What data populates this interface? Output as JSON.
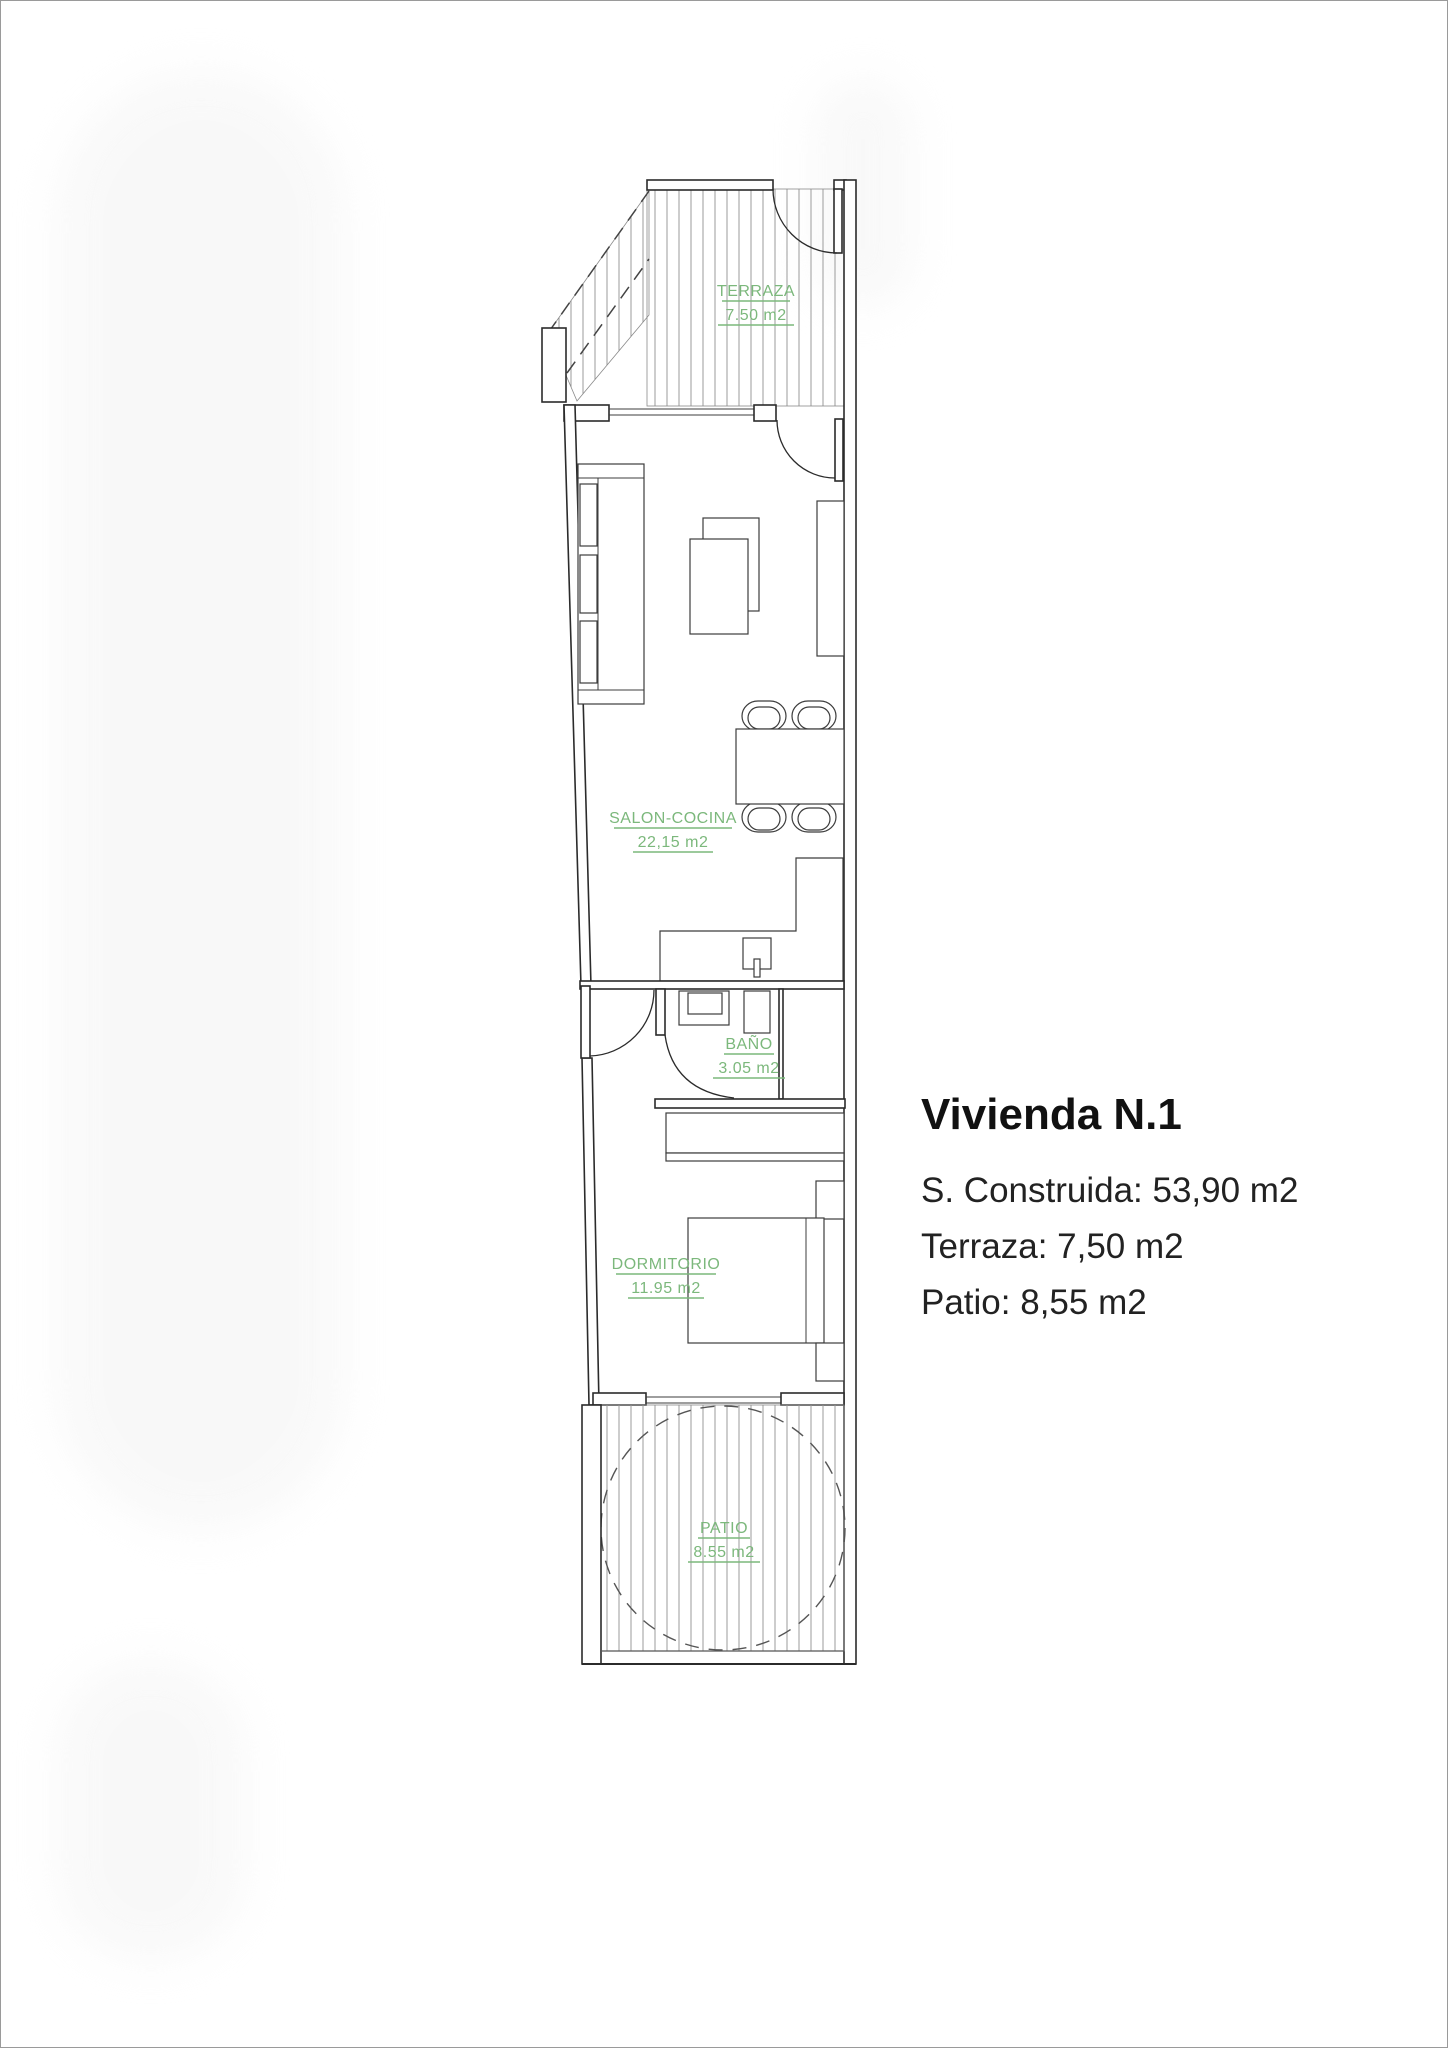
{
  "plan": {
    "label_color": "#7cb87c",
    "line_color": "#2b2b2b",
    "hatch_color": "#9b9b9b",
    "page_border_color": "#9a9a9a",
    "labels": {
      "terraza": {
        "name": "TERRAZA",
        "area": "7.50 m2"
      },
      "salon": {
        "name": "SALON-COCINA",
        "area": "22,15 m2"
      },
      "bano": {
        "name": "BAÑO",
        "area": "3.05 m2"
      },
      "dormitorio": {
        "name": "DORMITORIO",
        "area": "11.95 m2"
      },
      "patio": {
        "name": "PATIO",
        "area": "8.55 m2"
      }
    }
  },
  "info": {
    "title": "Vivienda N.1",
    "lines": [
      "S. Construida: 53,90 m2",
      "Terraza: 7,50 m2",
      "Patio: 8,55 m2"
    ]
  }
}
